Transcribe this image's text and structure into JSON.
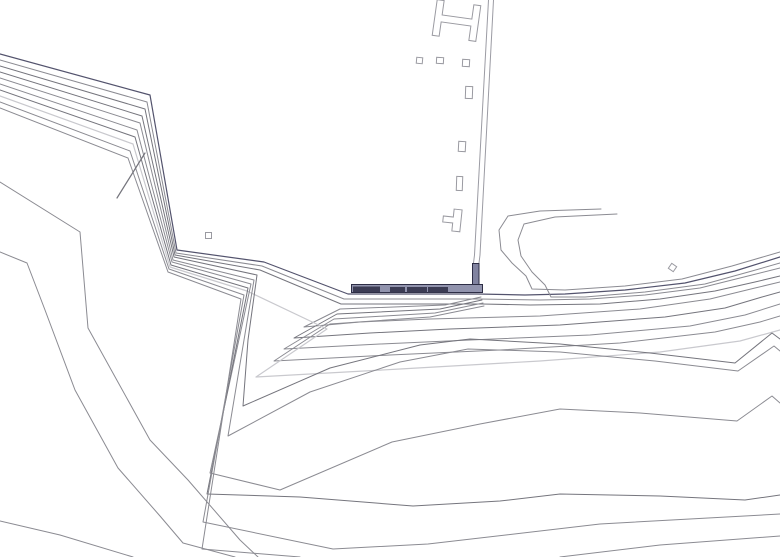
{
  "canvas": {
    "width": 780,
    "height": 557,
    "background": "#ffffff"
  },
  "palette": {
    "contour": "#8b8b92",
    "contour_dark": "#75757d",
    "contour_light": "#c9c9ce",
    "contour_navy": "#53536d",
    "road": "#9b9ba3",
    "outline": "#2d2d45",
    "building_fill": "#9193ad",
    "building_dark": "#3c3c54",
    "tower_fill": "#8183a0",
    "structure": "#9a9aa1"
  },
  "roads": [
    {
      "name": "road-edge-west",
      "color": "road",
      "width": 1,
      "points": [
        [
          488.5,
          0
        ],
        [
          474.5,
          255
        ],
        [
          473.5,
          263
        ]
      ]
    },
    {
      "name": "road-edge-east",
      "color": "road",
      "width": 1,
      "points": [
        [
          493.5,
          0
        ],
        [
          480,
          255
        ],
        [
          479,
          263
        ]
      ]
    }
  ],
  "contours": [
    {
      "name": "contour-building-toe",
      "color": "contour_navy",
      "width": 1.2,
      "points": [
        [
          0,
          54
        ],
        [
          150,
          95
        ],
        [
          177,
          250
        ],
        [
          264,
          262
        ],
        [
          348,
          294
        ],
        [
          478,
          294
        ],
        [
          525,
          295
        ],
        [
          565,
          294
        ],
        [
          625,
          290
        ],
        [
          685,
          283
        ],
        [
          735,
          271
        ],
        [
          780,
          257
        ]
      ]
    },
    {
      "name": "contour-fan-1",
      "color": "contour",
      "width": 1,
      "points": [
        [
          0,
          60
        ],
        [
          147,
          102
        ],
        [
          176,
          253
        ],
        [
          262,
          266
        ],
        [
          344,
          299
        ],
        [
          480,
          299
        ],
        [
          540,
          300
        ],
        [
          590,
          299
        ],
        [
          645,
          295
        ],
        [
          700,
          288
        ],
        [
          748,
          276
        ],
        [
          780,
          268
        ]
      ]
    },
    {
      "name": "contour-fan-2",
      "color": "contour_dark",
      "width": 1,
      "points": [
        [
          0,
          66
        ],
        [
          145,
          109
        ],
        [
          175,
          255
        ],
        [
          260,
          270
        ],
        [
          341,
          304
        ],
        [
          482,
          304
        ],
        [
          530,
          305
        ],
        [
          600,
          304
        ],
        [
          660,
          299
        ],
        [
          715,
          291
        ],
        [
          755,
          282
        ],
        [
          780,
          276
        ]
      ]
    },
    {
      "name": "contour-terrace-1",
      "color": "contour",
      "width": 1,
      "points": [
        [
          481,
          297
        ],
        [
          445,
          305
        ],
        [
          340,
          309
        ],
        [
          304,
          327
        ],
        [
          360,
          322
        ],
        [
          430,
          319
        ],
        [
          540,
          316
        ],
        [
          640,
          309
        ],
        [
          710,
          299
        ],
        [
          755,
          288
        ],
        [
          780,
          282
        ]
      ]
    },
    {
      "name": "contour-terrace-2",
      "color": "contour_dark",
      "width": 1,
      "points": [
        [
          482,
          300
        ],
        [
          440,
          309
        ],
        [
          337,
          314
        ],
        [
          294,
          338
        ],
        [
          370,
          333
        ],
        [
          450,
          329
        ],
        [
          560,
          325
        ],
        [
          665,
          317
        ],
        [
          725,
          308
        ],
        [
          762,
          297
        ],
        [
          780,
          292
        ]
      ]
    },
    {
      "name": "contour-terrace-3",
      "color": "contour",
      "width": 1,
      "points": [
        [
          483,
          303
        ],
        [
          435,
          313
        ],
        [
          334,
          319
        ],
        [
          284,
          349
        ],
        [
          380,
          344
        ],
        [
          470,
          340
        ],
        [
          590,
          335
        ],
        [
          690,
          326
        ],
        [
          745,
          315
        ],
        [
          780,
          304
        ]
      ]
    },
    {
      "name": "contour-terrace-4",
      "color": "contour",
      "width": 1,
      "points": [
        [
          484,
          306
        ],
        [
          430,
          317
        ],
        [
          330,
          324
        ],
        [
          274,
          361
        ],
        [
          390,
          355
        ],
        [
          500,
          350
        ],
        [
          620,
          343
        ],
        [
          715,
          332
        ],
        [
          760,
          322
        ],
        [
          780,
          316
        ]
      ]
    },
    {
      "name": "contour-light",
      "color": "contour_light",
      "width": 1.2,
      "points": [
        [
          0,
          96
        ],
        [
          133,
          144
        ],
        [
          170,
          267
        ],
        [
          247,
          291
        ],
        [
          327,
          329
        ],
        [
          256,
          377
        ],
        [
          400,
          369
        ],
        [
          540,
          361
        ],
        [
          660,
          352
        ],
        [
          740,
          341
        ],
        [
          780,
          330
        ]
      ]
    },
    {
      "name": "contour-valley-1",
      "color": "contour_dark",
      "width": 1,
      "points": [
        [
          0,
          72
        ],
        [
          142,
          116
        ],
        [
          174,
          257
        ],
        [
          257,
          275
        ],
        [
          248,
          340
        ],
        [
          243,
          406
        ],
        [
          330,
          368
        ],
        [
          420,
          345
        ],
        [
          470,
          339
        ],
        [
          560,
          344
        ],
        [
          650,
          353
        ],
        [
          735,
          363
        ],
        [
          772,
          333
        ],
        [
          780,
          339
        ]
      ]
    },
    {
      "name": "contour-valley-2",
      "color": "contour",
      "width": 1,
      "points": [
        [
          0,
          78
        ],
        [
          140,
          123
        ],
        [
          173,
          260
        ],
        [
          254,
          280
        ],
        [
          228,
          436
        ],
        [
          310,
          392
        ],
        [
          400,
          362
        ],
        [
          468,
          349
        ],
        [
          560,
          352
        ],
        [
          655,
          361
        ],
        [
          738,
          371
        ],
        [
          774,
          346
        ],
        [
          780,
          351
        ]
      ]
    },
    {
      "name": "contour-valley-3",
      "color": "contour",
      "width": 1,
      "points": [
        [
          0,
          84
        ],
        [
          137,
          130
        ],
        [
          172,
          262
        ],
        [
          251,
          284
        ],
        [
          210,
          473
        ],
        [
          280,
          490
        ],
        [
          392,
          442
        ],
        [
          480,
          424
        ],
        [
          560,
          409
        ],
        [
          640,
          413
        ],
        [
          737,
          421
        ],
        [
          772,
          396
        ],
        [
          780,
          403
        ]
      ]
    },
    {
      "name": "contour-valley-4",
      "color": "contour_dark",
      "width": 1,
      "points": [
        [
          0,
          90
        ],
        [
          135,
          137
        ],
        [
          171,
          265
        ],
        [
          248,
          288
        ],
        [
          207,
          494
        ],
        [
          300,
          497
        ],
        [
          413,
          506
        ],
        [
          500,
          501
        ],
        [
          560,
          494
        ],
        [
          660,
          496
        ],
        [
          745,
          500
        ],
        [
          780,
          495
        ]
      ]
    },
    {
      "name": "contour-valley-5",
      "color": "contour",
      "width": 1,
      "points": [
        [
          0,
          102
        ],
        [
          130,
          151
        ],
        [
          169,
          269
        ],
        [
          244,
          295
        ],
        [
          203,
          522
        ],
        [
          333,
          549
        ],
        [
          428,
          544
        ],
        [
          600,
          524
        ],
        [
          780,
          514
        ]
      ]
    },
    {
      "name": "contour-valley-6",
      "color": "contour",
      "width": 1,
      "points": [
        [
          0,
          108
        ],
        [
          128,
          158
        ],
        [
          168,
          272
        ],
        [
          241,
          299
        ],
        [
          202,
          549
        ],
        [
          300,
          557
        ]
      ]
    },
    {
      "name": "contour-west-outer-1",
      "color": "contour",
      "width": 1,
      "points": [
        [
          0,
          182
        ],
        [
          80,
          232
        ],
        [
          88,
          328
        ],
        [
          150,
          440
        ],
        [
          188,
          480
        ],
        [
          240,
          540
        ],
        [
          258,
          557
        ]
      ]
    },
    {
      "name": "contour-west-outer-2",
      "color": "contour",
      "width": 1,
      "points": [
        [
          0,
          252
        ],
        [
          27,
          263
        ],
        [
          45,
          310
        ],
        [
          75,
          390
        ],
        [
          118,
          468
        ],
        [
          160,
          516
        ],
        [
          183,
          543
        ],
        [
          235,
          557
        ]
      ]
    },
    {
      "name": "contour-southwest-corner",
      "color": "contour",
      "width": 1,
      "points": [
        [
          0,
          521
        ],
        [
          60,
          535
        ],
        [
          133,
          557
        ]
      ]
    },
    {
      "name": "contour-southeast-corner",
      "color": "contour",
      "width": 1,
      "points": [
        [
          560,
          557
        ],
        [
          660,
          545
        ],
        [
          780,
          536
        ]
      ]
    },
    {
      "name": "contour-hairpin-1",
      "color": "contour",
      "width": 1,
      "points": [
        [
          601,
          209
        ],
        [
          540,
          211
        ],
        [
          508,
          216
        ],
        [
          499,
          230
        ],
        [
          501,
          250
        ],
        [
          512,
          263
        ],
        [
          526,
          276
        ],
        [
          532,
          289
        ],
        [
          565,
          290
        ],
        [
          625,
          286
        ],
        [
          682,
          279
        ],
        [
          732,
          266
        ],
        [
          780,
          252
        ]
      ]
    },
    {
      "name": "contour-hairpin-2",
      "color": "contour",
      "width": 1,
      "points": [
        [
          617,
          214
        ],
        [
          555,
          217
        ],
        [
          524,
          224
        ],
        [
          518,
          240
        ],
        [
          521,
          256
        ],
        [
          532,
          272
        ],
        [
          545,
          285
        ],
        [
          551,
          297
        ],
        [
          585,
          297
        ],
        [
          645,
          292
        ],
        [
          705,
          284
        ],
        [
          752,
          271
        ],
        [
          780,
          263
        ]
      ]
    },
    {
      "name": "slope-tick-mark",
      "color": "contour_dark",
      "width": 1.2,
      "points": [
        [
          145,
          153
        ],
        [
          117,
          198
        ]
      ]
    }
  ],
  "buildings": {
    "bar": {
      "name": "main-building-bar",
      "x": 351.5,
      "y": 284.5,
      "w": 131,
      "h": 8
    },
    "segments": [
      {
        "name": "building-dark-segment",
        "x": 353,
        "y": 286.5,
        "w": 27,
        "h": 5.5
      },
      {
        "name": "building-dark-segment",
        "x": 390,
        "y": 287,
        "w": 15,
        "h": 5.5
      },
      {
        "name": "building-dark-segment",
        "x": 407,
        "y": 287,
        "w": 20,
        "h": 5.5
      },
      {
        "name": "building-dark-segment",
        "x": 428,
        "y": 287,
        "w": 20,
        "h": 5.5
      }
    ],
    "tower": {
      "name": "building-north-wing",
      "x": 472.5,
      "y": 263.5,
      "w": 6.5,
      "h": 29
    }
  },
  "structures": {
    "h_building": {
      "name": "h-shaped-structure",
      "cx": 456.5,
      "cy": 20.5,
      "rotate": 8,
      "path": "M-22,-18 L-15,-18 L-15,-3.5 L15,-3.5 L15,-18 L22,-18 L22,18 L15,18 L15,3.5 L-15,3.5 L-15,18 L-22,18 Z"
    },
    "t_building": {
      "name": "t-shaped-structure",
      "cx": 453,
      "cy": 220,
      "rotate": 6,
      "path": "M0,-11 L8,-11 L8,11 L0,11 L0,3 L-10,3 L-10,-3 L0,-3 Z"
    },
    "squares": [
      {
        "name": "small-structure",
        "x": 416.5,
        "y": 57.5,
        "w": 6,
        "h": 6,
        "rotate": 5
      },
      {
        "name": "small-structure",
        "x": 436.5,
        "y": 57.5,
        "w": 7,
        "h": 6,
        "rotate": 3
      },
      {
        "name": "small-structure",
        "x": 462.5,
        "y": 59.5,
        "w": 7,
        "h": 7,
        "rotate": 3
      },
      {
        "name": "small-structure",
        "x": 465.5,
        "y": 86.5,
        "w": 7,
        "h": 12,
        "rotate": 2
      },
      {
        "name": "small-structure",
        "x": 458.5,
        "y": 141.5,
        "w": 7,
        "h": 10,
        "rotate": 3
      },
      {
        "name": "small-structure",
        "x": 456.5,
        "y": 176.5,
        "w": 6,
        "h": 14,
        "rotate": 2
      },
      {
        "name": "small-structure",
        "x": 205.5,
        "y": 232.5,
        "w": 6,
        "h": 6,
        "rotate": 0
      },
      {
        "name": "small-structure",
        "x": 669.5,
        "y": 264.5,
        "w": 6,
        "h": 6,
        "rotate": 35
      }
    ]
  }
}
